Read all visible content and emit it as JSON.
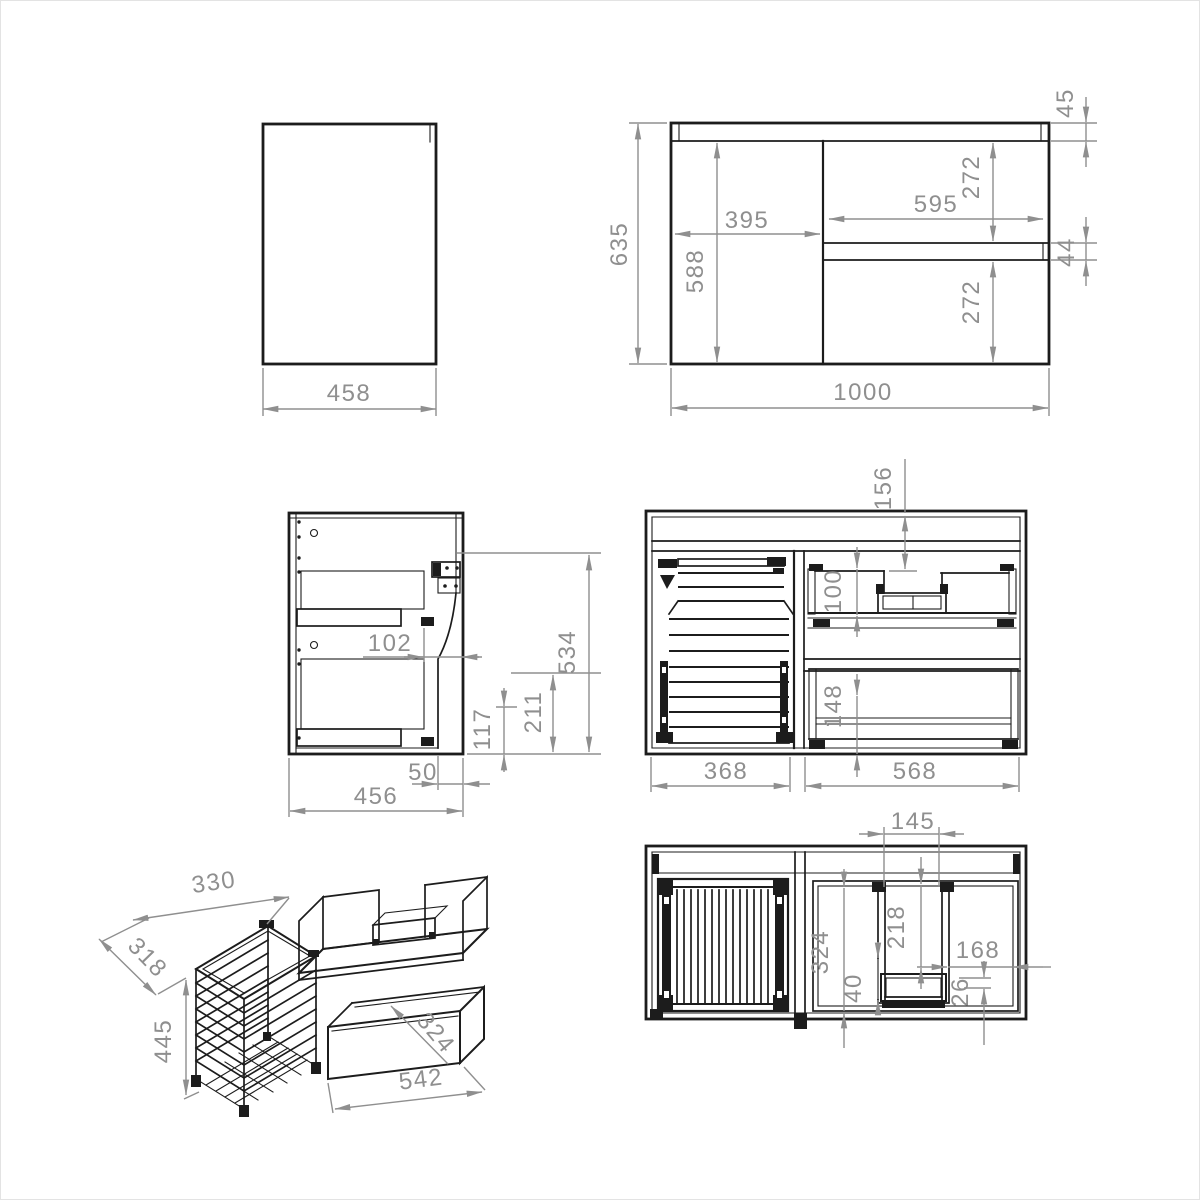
{
  "views": {
    "side_panel": {
      "width": "458"
    },
    "front_elevation": {
      "overall_height": "635",
      "door_width": "395",
      "door_height": "588",
      "drawer_front_width": "595",
      "top_rail_height": "45",
      "top_drawer_height": "272",
      "drawer_gap": "44",
      "bottom_drawer_height": "272",
      "overall_width": "1000"
    },
    "side_section": {
      "slide_offset": "102",
      "inner_height": "534",
      "mid_height": "211",
      "slide_height": "117",
      "back_clearance": "50",
      "depth": "456"
    },
    "front_section": {
      "top_clearance": "156",
      "upper_inner_height": "100",
      "lower_inner_height": "148",
      "left_compartment_width": "368",
      "right_compartment_width": "568"
    },
    "isometric": {
      "basket_width": "330",
      "basket_depth": "318",
      "basket_height": "445",
      "drawer_depth": "324",
      "drawer_width": "542"
    },
    "plan_section": {
      "cutout_width": "145",
      "depth": "324",
      "cutout_depth": "218",
      "right_section_width": "168",
      "tray_width": "40",
      "clearance": "26"
    }
  }
}
